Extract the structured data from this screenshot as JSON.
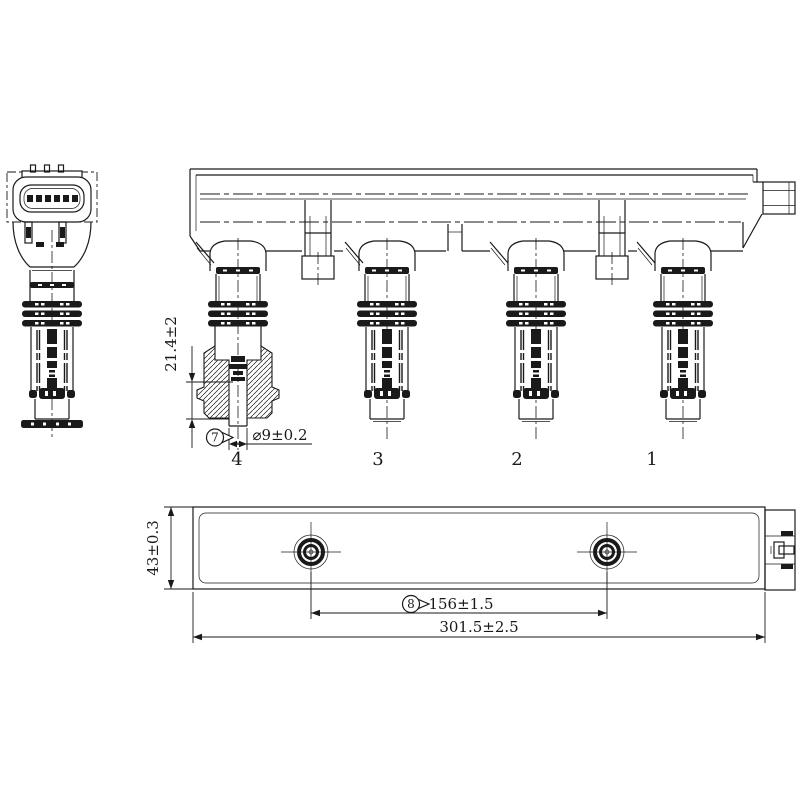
{
  "drawing": {
    "coil_labels": [
      "4",
      "3",
      "2",
      "1"
    ],
    "balloons": {
      "tip_diameter": "7",
      "hole_spacing": "8"
    },
    "dimensions": {
      "tip_length": "21.4±2",
      "tip_diameter": "⌀9±0.2",
      "rail_height": "43±0.3",
      "hole_spacing": "156±1.5",
      "overall_length": "301.5±2.5"
    },
    "colors": {
      "ink": "#1a1a1a",
      "paper": "#ffffff"
    }
  }
}
